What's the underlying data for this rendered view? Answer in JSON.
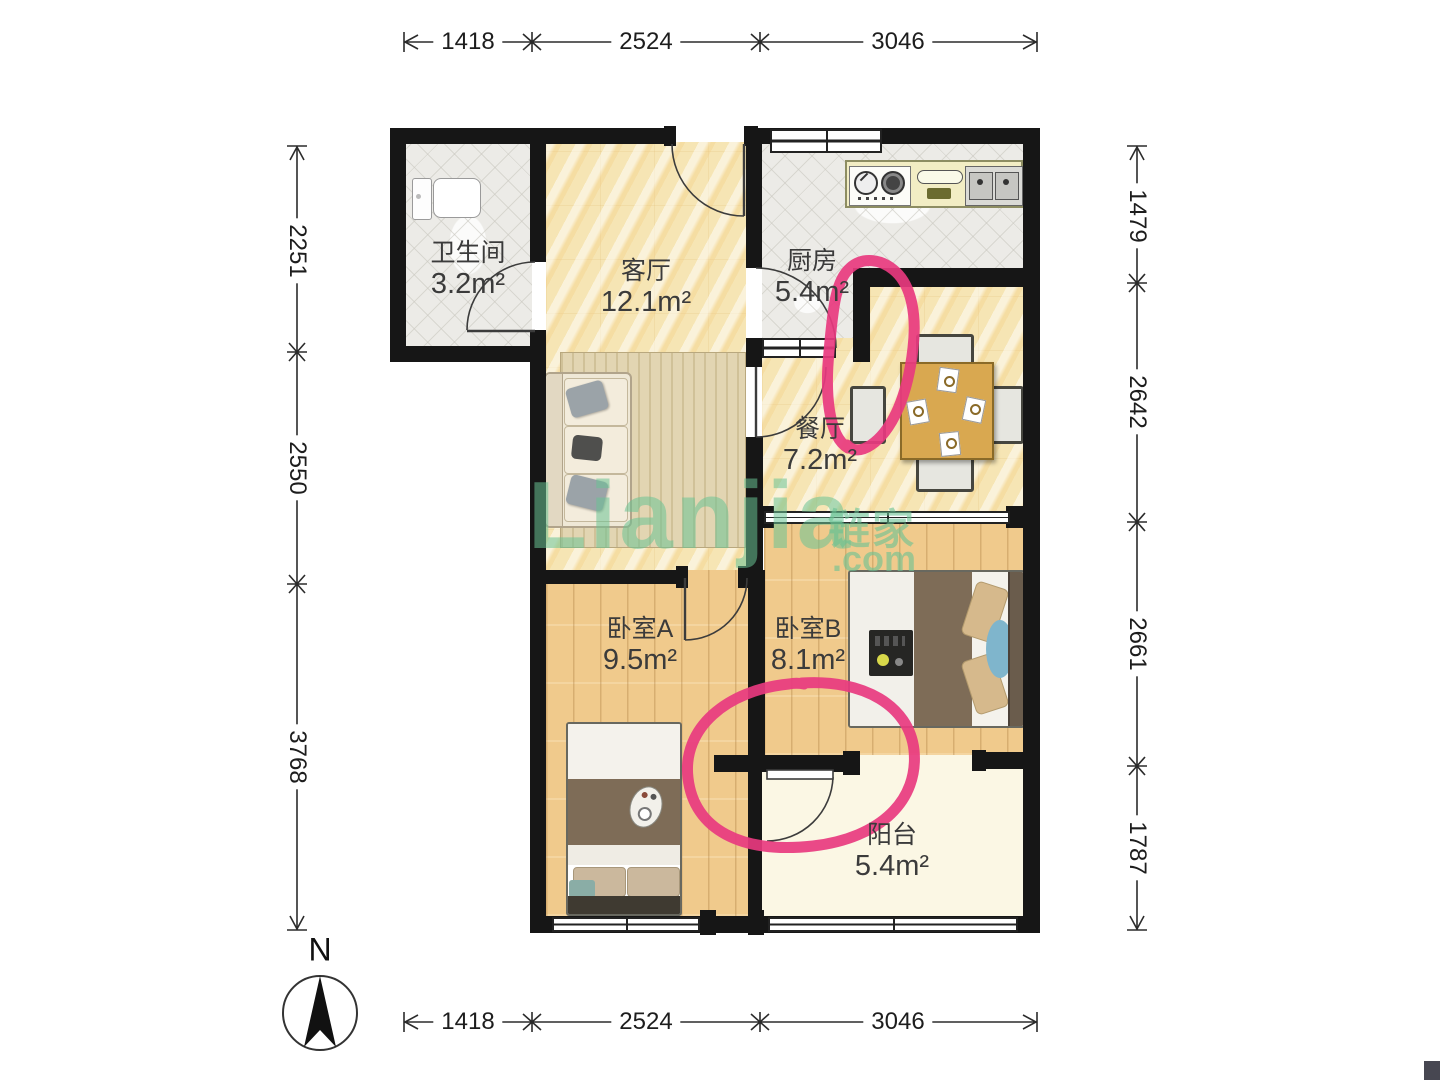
{
  "rooms": {
    "bathroom": {
      "name": "卫生间",
      "area": "3.2m²"
    },
    "living": {
      "name": "客厅",
      "area": "12.1m²"
    },
    "kitchen": {
      "name": "厨房",
      "area": "5.4m²"
    },
    "dining": {
      "name": "餐厅",
      "area": "7.2m²"
    },
    "bedroomA": {
      "name": "卧室A",
      "area": "9.5m²"
    },
    "bedroomB": {
      "name": "卧室B",
      "area": "8.1m²"
    },
    "balcony": {
      "name": "阳台",
      "area": "5.4m²"
    }
  },
  "dimensions": {
    "top": [
      "1418",
      "2524",
      "3046"
    ],
    "bottom": [
      "1418",
      "2524",
      "3046"
    ],
    "left": [
      "2251",
      "2550",
      "3768"
    ],
    "right": [
      "1479",
      "2642",
      "2661",
      "1787"
    ]
  },
  "watermark": {
    "latin": "Lianjia",
    "cn": "链家",
    "tld": ".com"
  },
  "compass": {
    "label": "N"
  },
  "annotations": {
    "color": "#e8397f"
  },
  "colors": {
    "wall": "#161616",
    "marble_floor": "#f6e5b4",
    "wood_floor": "#f0ca8c",
    "tile_floor": "#ecebe7",
    "balcony_floor": "#fbf7e4",
    "watermark_green": "#69c293"
  }
}
